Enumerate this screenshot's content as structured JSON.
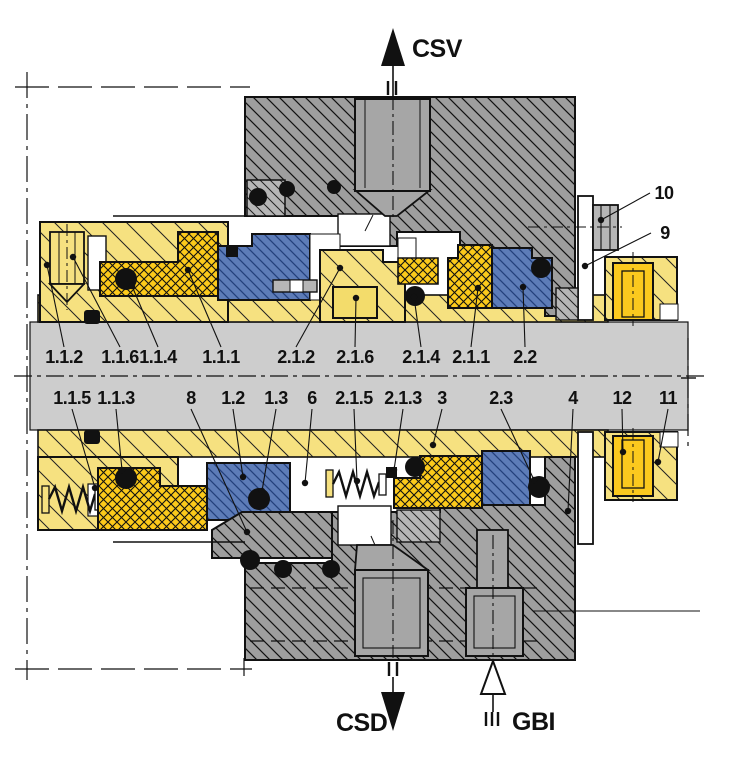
{
  "diagram": {
    "kind": "mechanical-seal-cross-section",
    "colors": {
      "housing_grey": "#9e9e9e",
      "light_grey_part": "#b6b6b6",
      "plug_grey": "#a6a6a6",
      "shaft_grey": "#cdcdcd",
      "gland_yellow": "#f6e180",
      "face_gold": "#fcca1b",
      "plug_bright_yellow": "#fbc91e",
      "seat_blue": "#5d7cb8",
      "seat_blue_hatch": "#23407c",
      "oring_black": "#111111",
      "line_black": "#111111"
    },
    "part_labels_upper": [
      {
        "label": "1.1.2",
        "x": 64,
        "y": 363,
        "tx": 47,
        "ty": 265
      },
      {
        "label": "1.1.6",
        "x": 120,
        "y": 363,
        "tx": 73,
        "ty": 257
      },
      {
        "label": "1.1.4",
        "x": 158,
        "y": 363,
        "tx": 132,
        "ty": 286
      },
      {
        "label": "1.1.1",
        "x": 221,
        "y": 363,
        "tx": 188,
        "ty": 270
      },
      {
        "label": "2.1.2",
        "x": 296,
        "y": 363,
        "tx": 340,
        "ty": 268
      },
      {
        "label": "2.1.6",
        "x": 355,
        "y": 363,
        "tx": 356,
        "ty": 298
      },
      {
        "label": "2.1.4",
        "x": 421,
        "y": 363,
        "tx": 414,
        "ty": 297
      },
      {
        "label": "2.1.1",
        "x": 471,
        "y": 363,
        "tx": 478,
        "ty": 288
      },
      {
        "label": "2.2",
        "x": 525,
        "y": 363,
        "tx": 523,
        "ty": 287
      }
    ],
    "part_labels_lower": [
      {
        "label": "1.1.5",
        "x": 72,
        "y": 404,
        "tx": 95,
        "ty": 488
      },
      {
        "label": "1.1.3",
        "x": 116,
        "y": 404,
        "tx": 122,
        "ty": 470
      },
      {
        "label": "8",
        "x": 191,
        "y": 404,
        "tx": 247,
        "ty": 532
      },
      {
        "label": "1.2",
        "x": 233,
        "y": 404,
        "tx": 243,
        "ty": 477
      },
      {
        "label": "1.3",
        "x": 276,
        "y": 404,
        "tx": 262,
        "ty": 491
      },
      {
        "label": "6",
        "x": 312,
        "y": 404,
        "tx": 305,
        "ty": 483
      },
      {
        "label": "2.1.5",
        "x": 354,
        "y": 404,
        "tx": 357,
        "ty": 481
      },
      {
        "label": "2.1.3",
        "x": 403,
        "y": 404,
        "tx": 394,
        "ty": 470
      },
      {
        "label": "3",
        "x": 442,
        "y": 404,
        "tx": 433,
        "ty": 445
      },
      {
        "label": "2.3",
        "x": 501,
        "y": 404,
        "tx": 534,
        "ty": 480
      },
      {
        "label": "4",
        "x": 573,
        "y": 404,
        "tx": 568,
        "ty": 511
      },
      {
        "label": "12",
        "x": 622,
        "y": 404,
        "tx": 623,
        "ty": 452
      },
      {
        "label": "11",
        "x": 668,
        "y": 404,
        "tx": 658,
        "ty": 462
      }
    ],
    "part_labels_side": [
      {
        "label": "10",
        "x": 664,
        "y": 199,
        "tx": 601,
        "ty": 220
      },
      {
        "label": "9",
        "x": 665,
        "y": 239,
        "tx": 585,
        "ty": 266
      }
    ],
    "flow_ports": [
      {
        "code": "CSV",
        "direction": "up",
        "style": "filled",
        "text_x": 412,
        "text_y": 57,
        "axis_x": 393
      },
      {
        "code": "CSD",
        "direction": "down",
        "style": "filled",
        "text_x": 336,
        "text_y": 731,
        "axis_x": 393
      },
      {
        "code": "GBI",
        "direction": "up",
        "style": "outline",
        "text_x": 512,
        "text_y": 730,
        "axis_x": 493
      }
    ]
  }
}
